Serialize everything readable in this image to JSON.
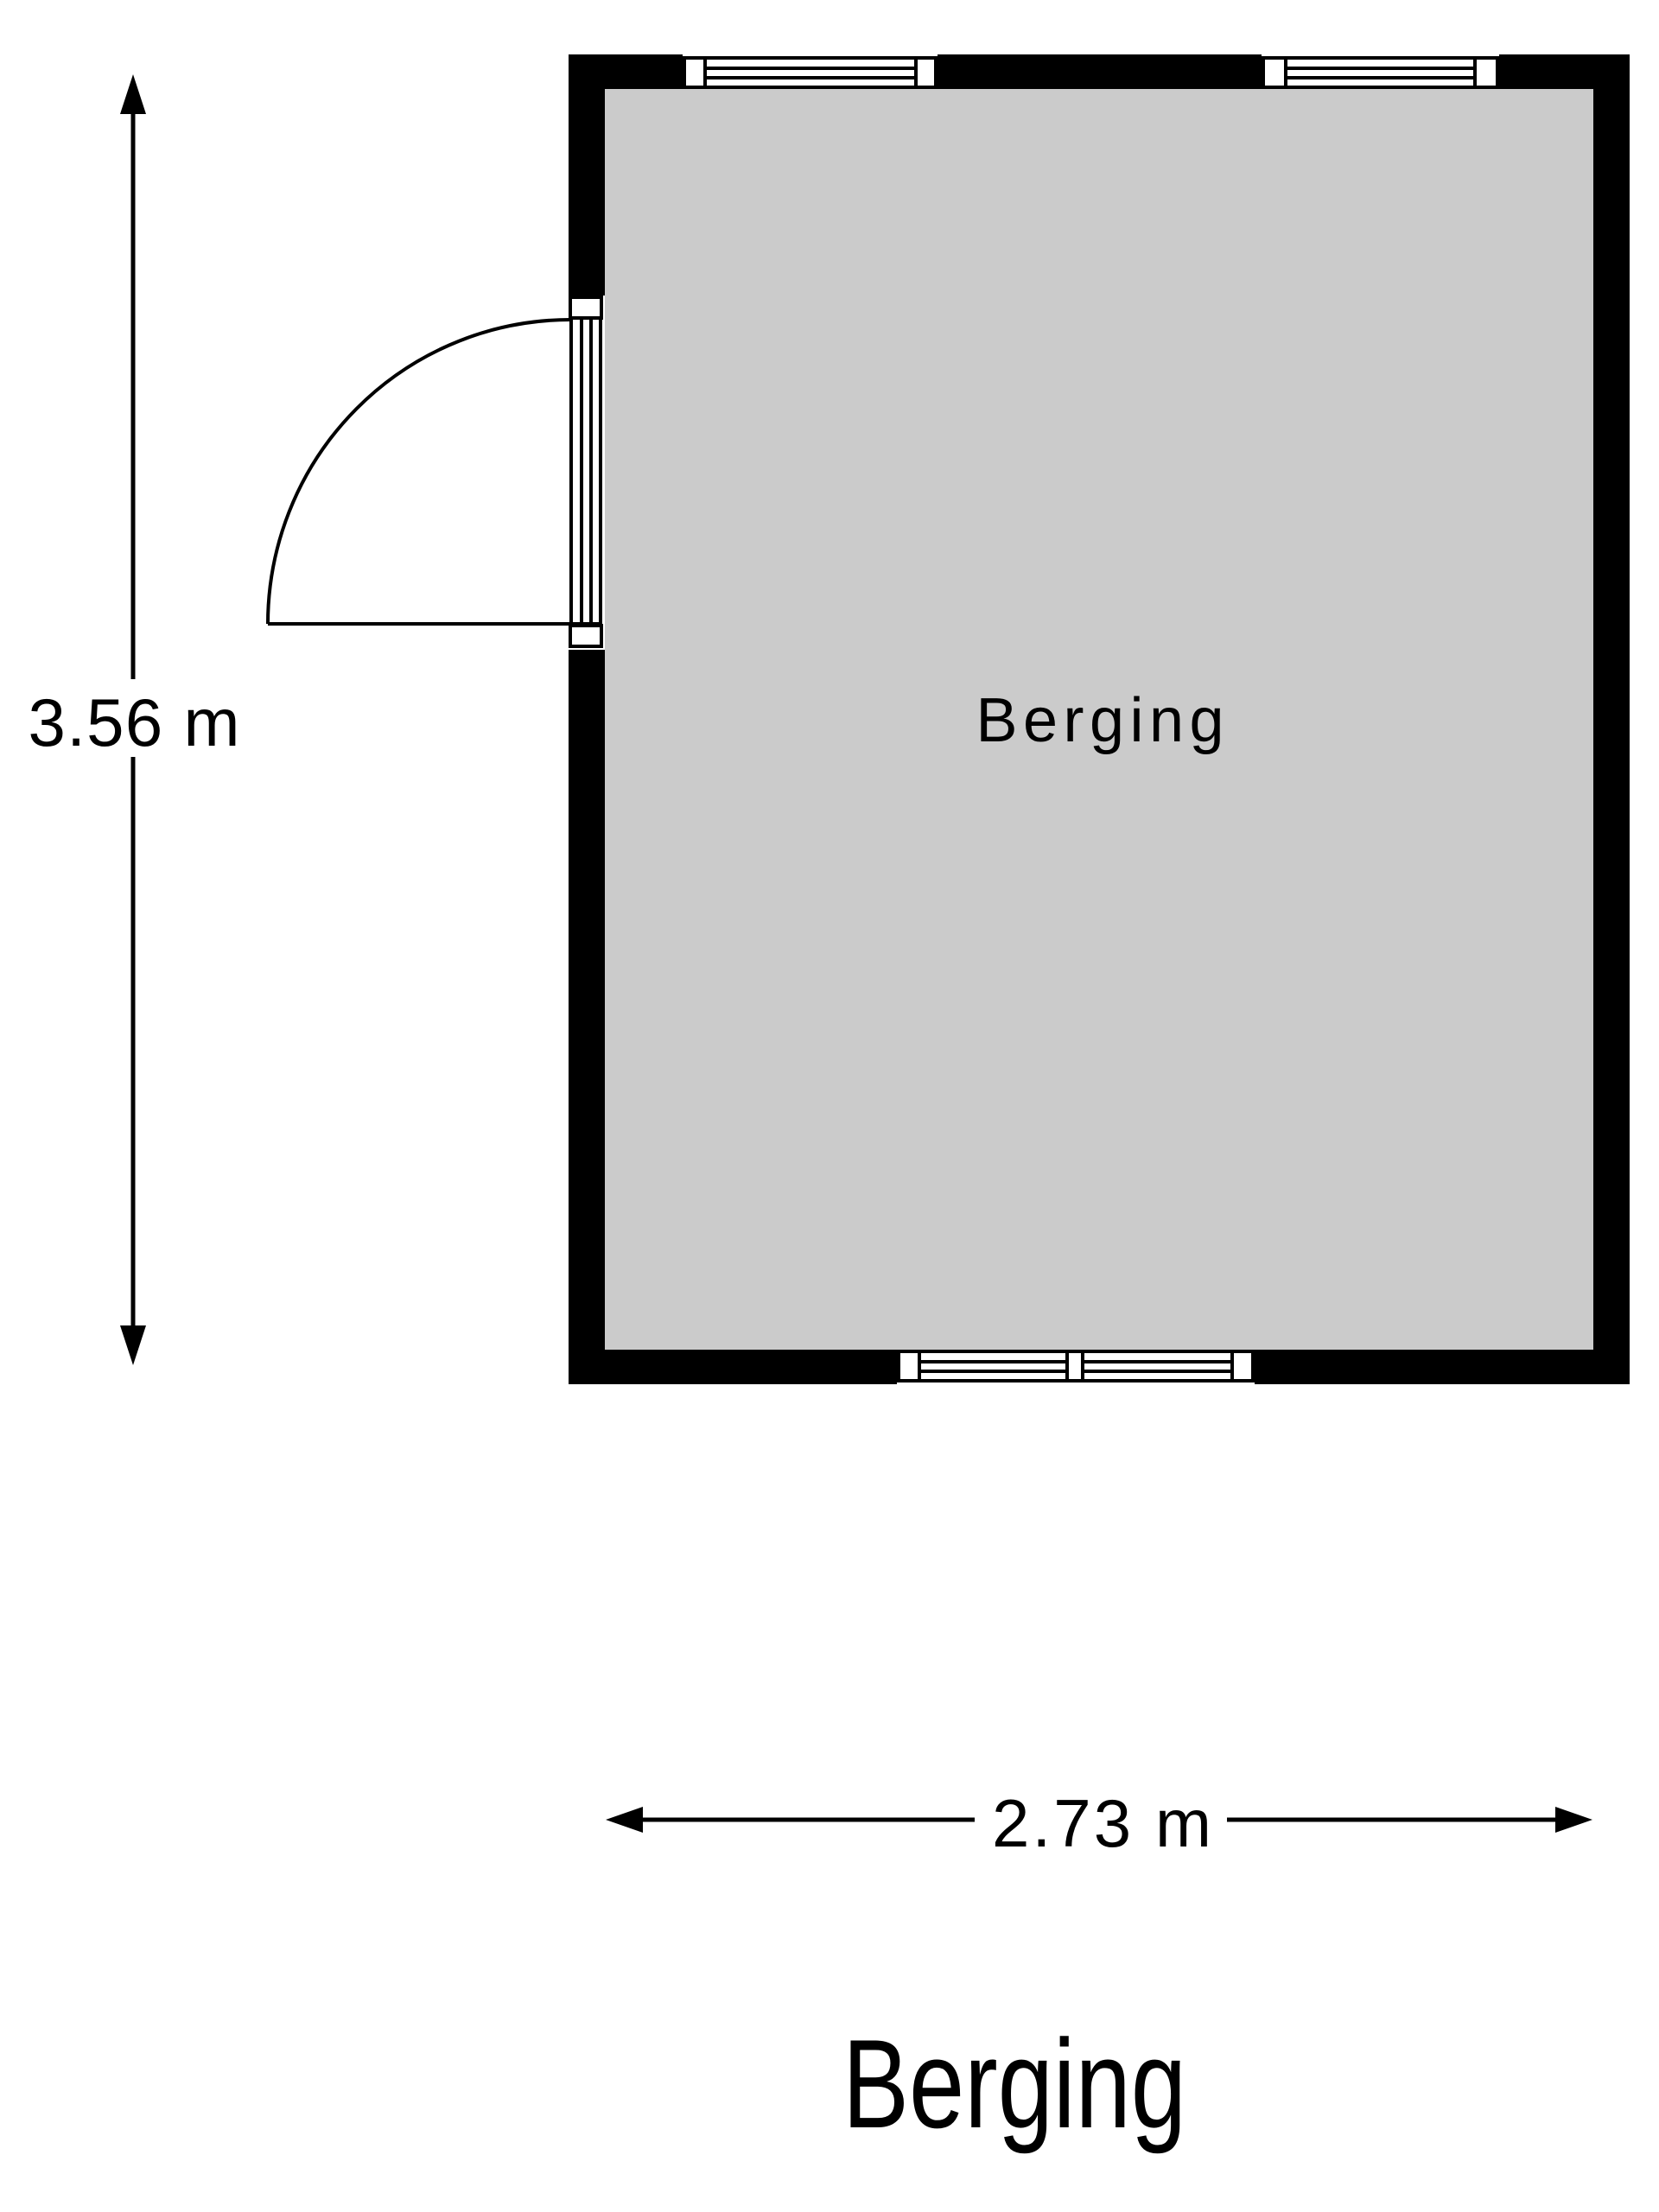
{
  "page": {
    "background": "#FFFFFF"
  },
  "floorplan": {
    "title": "Berging",
    "room": {
      "label": "Berging",
      "floor_color": "#CBCBCB",
      "wall_color": "#000000",
      "line_color": "#000000"
    },
    "dimensions": {
      "height": "3.56 m",
      "width": "2.73 m",
      "height_value": 3.56,
      "width_value": 2.73,
      "unit": "m"
    }
  }
}
